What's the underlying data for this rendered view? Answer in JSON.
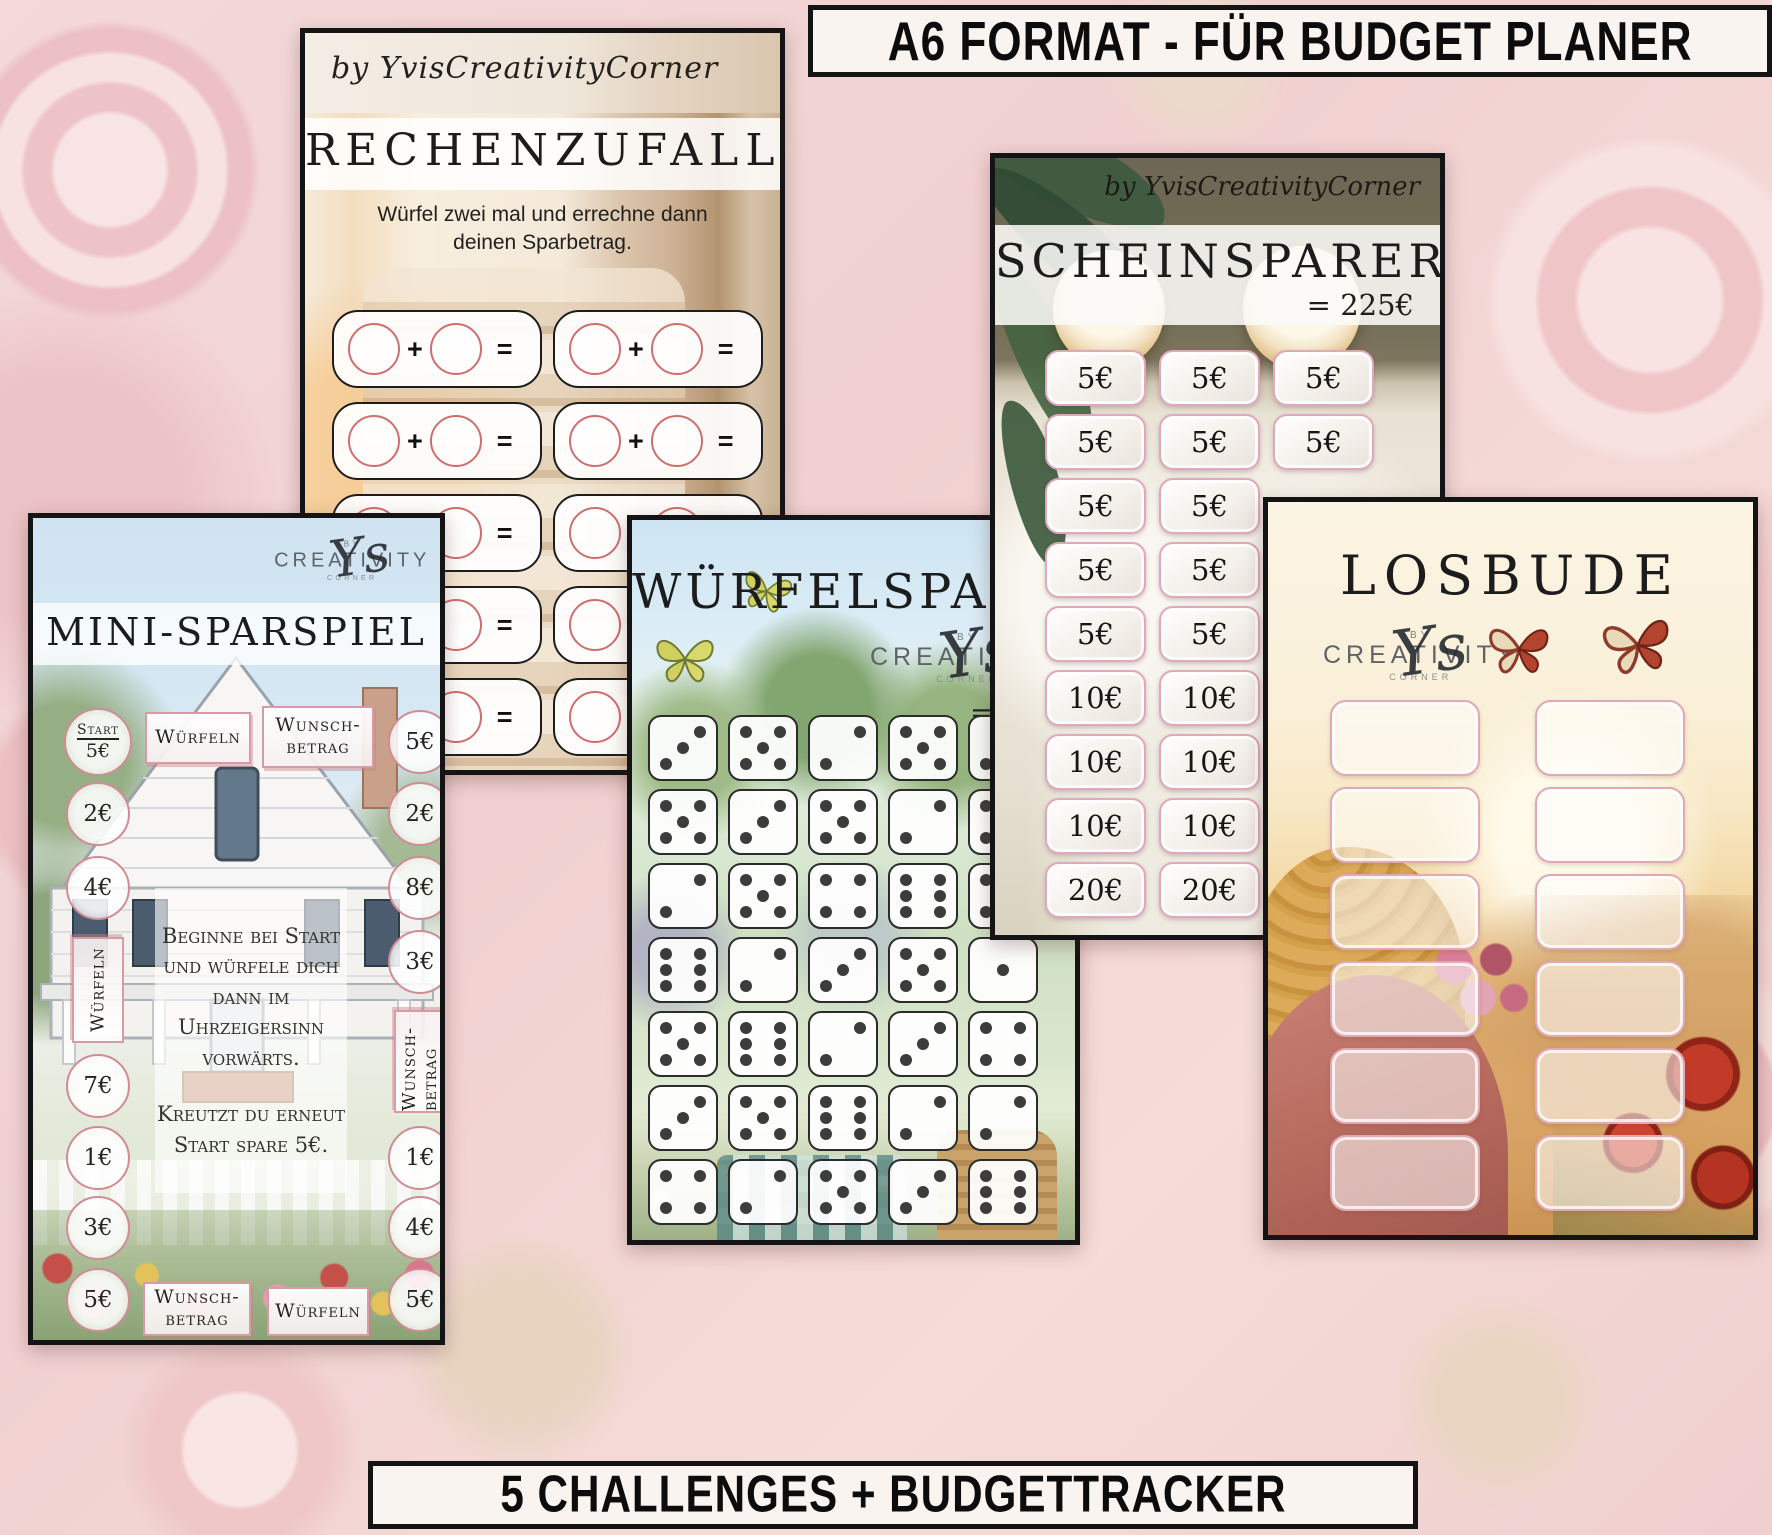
{
  "banners": {
    "top": "A6 FORMAT - FÜR BUDGET PLANER",
    "bottom": "5 CHALLENGES + BUDGETTRACKER"
  },
  "logos": {
    "long": "by YvisCreativityCorner",
    "by": "BY",
    "main": "CREATIVITY",
    "corner": "CORNER",
    "script": "Ys"
  },
  "cards": {
    "rechenzufall": {
      "title": "RECHENZUFALL",
      "subtitle": "Würfel zwei mal und errechne dann deinen Sparbetrag.",
      "plus": "+",
      "equals": "=",
      "box_rows": 5,
      "box_columns": 2
    },
    "wuerfelsparen": {
      "title": "WÜRFELSPAREN",
      "total_prefix": "=",
      "dice_rows": [
        [
          3,
          5,
          2,
          5,
          3
        ],
        [
          5,
          3,
          5,
          2,
          5
        ],
        [
          2,
          5,
          4,
          6,
          5
        ],
        [
          6,
          2,
          3,
          5,
          1
        ],
        [
          5,
          6,
          2,
          3,
          4
        ],
        [
          3,
          5,
          6,
          2,
          2
        ],
        [
          4,
          2,
          5,
          3,
          6
        ]
      ]
    },
    "scheinsparer": {
      "title": "SCHEINSPARER",
      "total": "= 225€",
      "rows": [
        [
          "5€",
          "5€",
          "5€"
        ],
        [
          "5€",
          "5€",
          "5€"
        ],
        [
          "5€",
          "5€"
        ],
        [
          "5€",
          "5€"
        ],
        [
          "5€",
          "5€"
        ],
        [
          "10€",
          "10€"
        ],
        [
          "10€",
          "10€"
        ],
        [
          "10€",
          "10€"
        ],
        [
          "20€",
          "20€"
        ]
      ]
    },
    "mini_sparspiel": {
      "title": "MINI-SPARSPIEL",
      "top_boxes": [
        "Würfeln",
        "Wunsch-betrag"
      ],
      "bottom_boxes": [
        "Wunsch-betrag",
        "Würfeln"
      ],
      "left_column": [
        {
          "type": "start",
          "line1": "Start",
          "line2": "5€"
        },
        {
          "type": "circle",
          "label": "2€"
        },
        {
          "type": "circle",
          "label": "4€"
        },
        {
          "type": "vbox",
          "label": "Würfeln"
        },
        {
          "type": "circle",
          "label": "7€"
        },
        {
          "type": "circle",
          "label": "1€"
        },
        {
          "type": "circle",
          "label": "3€"
        },
        {
          "type": "circle",
          "label": "5€"
        }
      ],
      "right_column": [
        {
          "type": "circle",
          "label": "5€"
        },
        {
          "type": "circle",
          "label": "2€"
        },
        {
          "type": "circle",
          "label": "8€"
        },
        {
          "type": "circle",
          "label": "3€"
        },
        {
          "type": "vbox",
          "label": "Wunsch-betrag"
        },
        {
          "type": "circle",
          "label": "1€"
        },
        {
          "type": "circle",
          "label": "4€"
        },
        {
          "type": "circle",
          "label": "5€"
        }
      ],
      "instructions": [
        "Beginne bei Start und würfele dich dann im Uhrzeigersinn vorwärts.",
        "Kreutzt du erneut Start spare 5€."
      ]
    },
    "losbude": {
      "title": "LOSBUDE",
      "slot_count": 12
    }
  }
}
